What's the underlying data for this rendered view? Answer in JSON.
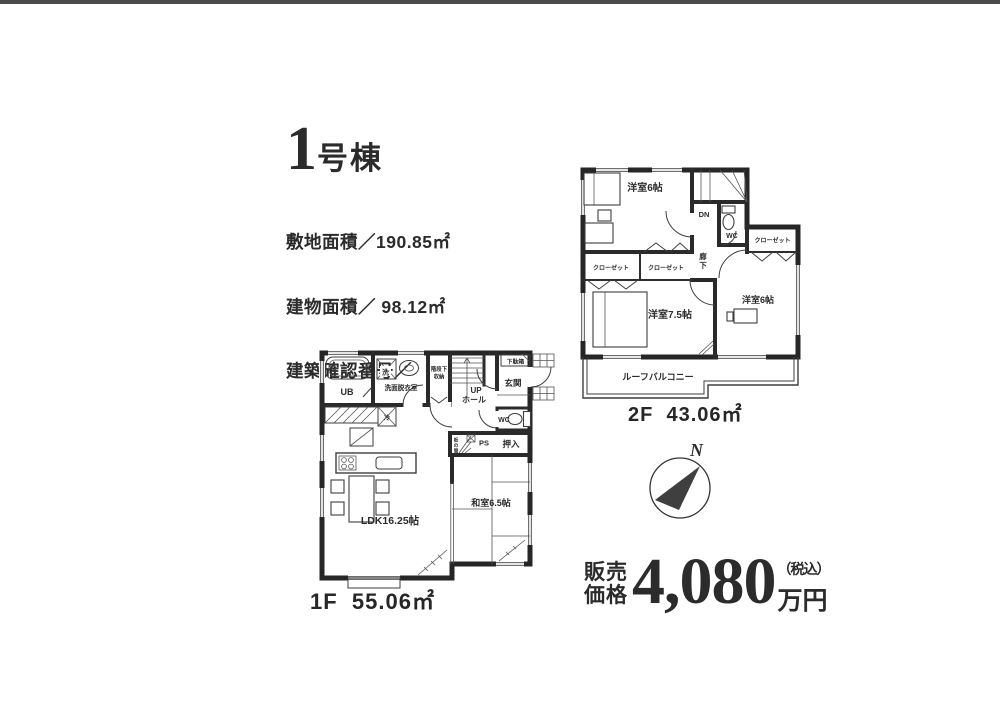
{
  "title": {
    "number": "1",
    "suffix": "号棟"
  },
  "property": {
    "line1": "敷地面積／190.85㎡",
    "line2": "建物面積／ 98.12㎡",
    "line3": "建築確認番号／"
  },
  "floor2": {
    "area_label": "2F  43.06㎡",
    "room_west6_top": "洋室6帖",
    "room_west75": "洋室7.5帖",
    "room_west6_right": "洋室6帖",
    "closet_a": "クローゼット",
    "closet_b": "クローゼット",
    "closet_c": "クローゼット",
    "wc": "WC",
    "dn": "DN",
    "hallway_chars": [
      "廊",
      "下"
    ],
    "balcony": "ルーフバルコニー"
  },
  "floor1": {
    "area_label": "1F  55.06㎡",
    "ldk": "LDK16.25帖",
    "washitsu": "和室6.5帖",
    "ub": "UB",
    "washroom": "洗面脱衣室",
    "washer": "洗",
    "fridge": "冷",
    "stair_storage_lines": [
      "階段下",
      "収納"
    ],
    "up": "UP",
    "hall": "ホール",
    "entrance": "玄関",
    "shoe_box": "下駄箱",
    "wc": "WC",
    "ps": "PS",
    "oshiire": "押入",
    "itanoma_chars": [
      "板",
      "の",
      "間"
    ]
  },
  "compass": {
    "north": "N"
  },
  "price": {
    "label_line1": "販売",
    "label_line2": "価格",
    "amount": "4,080",
    "tax_note": "（税込）",
    "unit": "万円"
  }
}
